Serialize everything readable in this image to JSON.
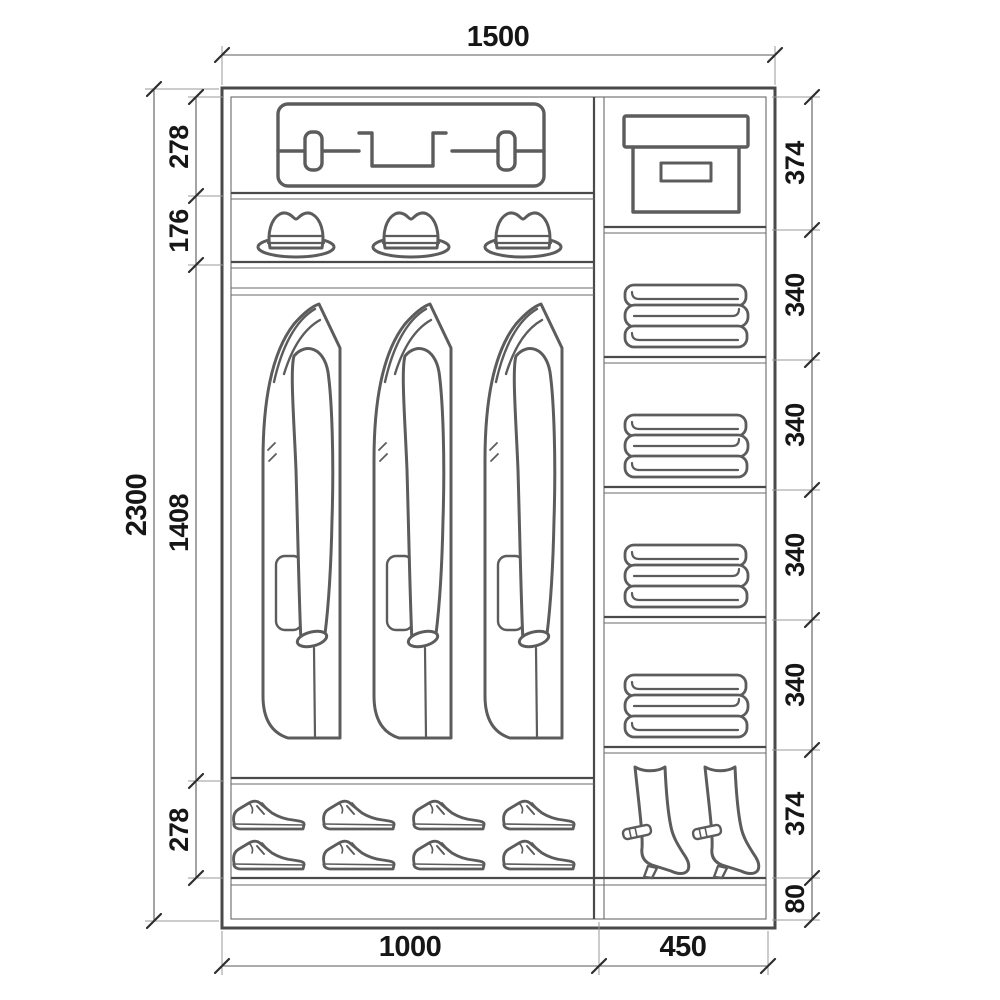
{
  "drawing": {
    "kind": "wardrobe-interior-elevation",
    "background": "#ffffff",
    "line_color": "#4a4a4a",
    "text_color": "#161616"
  },
  "dimensions": {
    "overall_width": "1500",
    "overall_height": "2300",
    "left_sections": [
      "278",
      "176",
      "1408",
      "278"
    ],
    "right_sections": [
      "374",
      "340",
      "340",
      "340",
      "340",
      "374"
    ],
    "plinth_height": "80",
    "bottom_left_width": "1000",
    "bottom_right_width": "450"
  },
  "contents": {
    "left_top": "suitcase",
    "left_hat_shelf": "fedora hats x3",
    "left_hanging": "coats on rail x3",
    "left_bottom": "dress shoes x8",
    "right_top": "storage box",
    "right_shelves": "folded blankets x4",
    "right_bottom": "high-heel boots x2"
  }
}
